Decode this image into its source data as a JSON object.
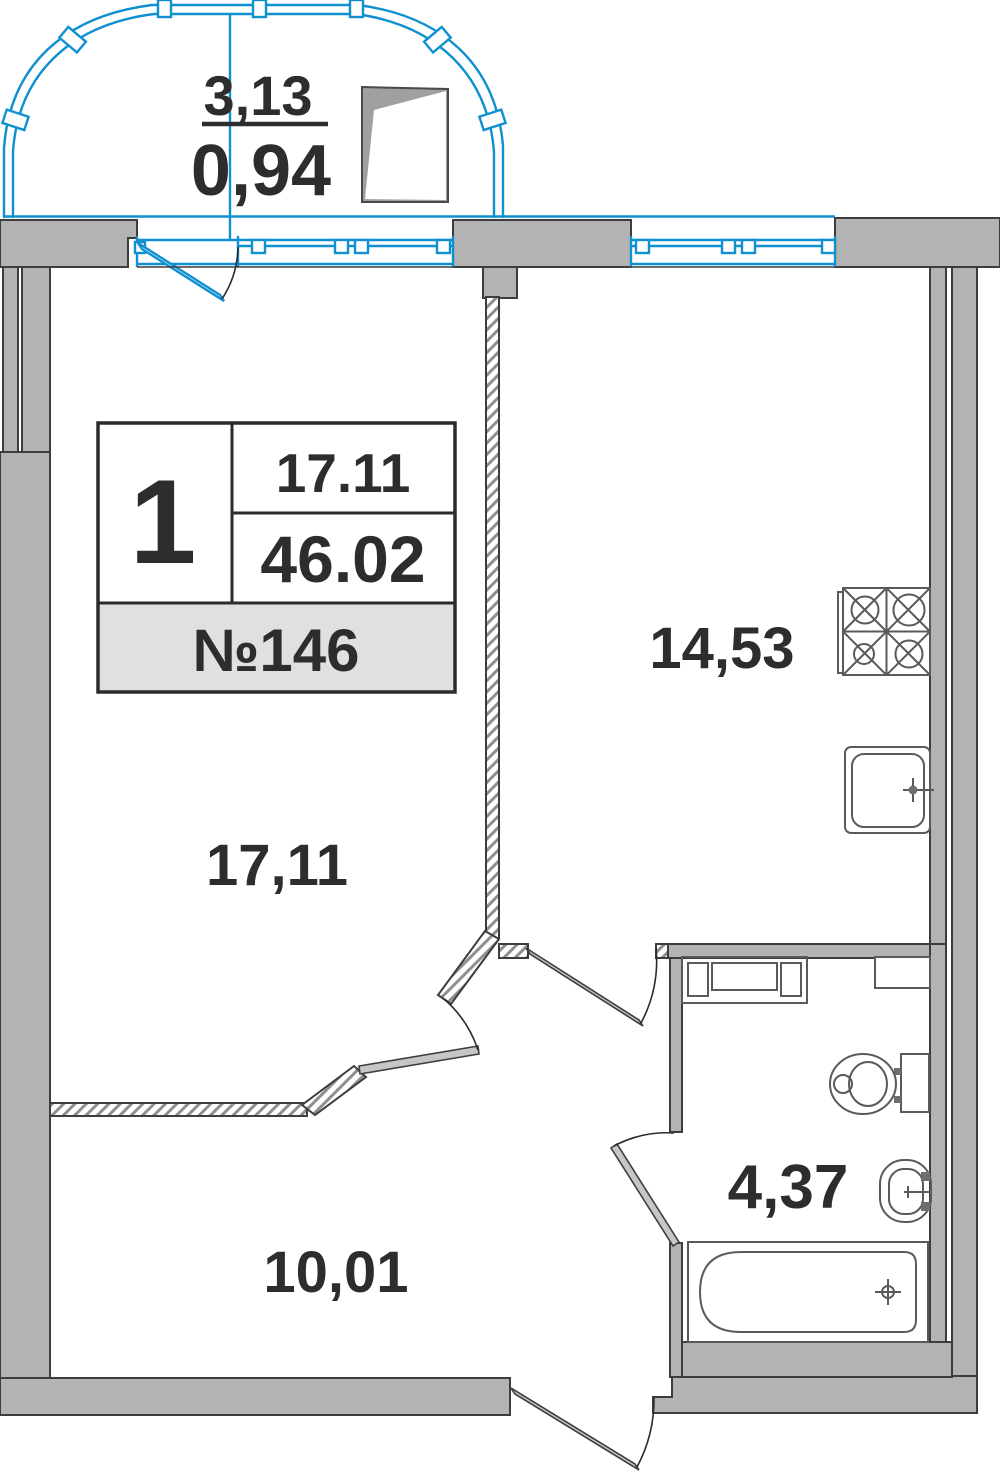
{
  "balcony": {
    "area_total": "3,13",
    "area_reduced": "0,94"
  },
  "info_card": {
    "rooms_count": "1",
    "living_area": "17.11",
    "total_area": "46.02",
    "unit_label": "№146"
  },
  "room_labels": {
    "living": "17,11",
    "kitchen": "14,53",
    "hall": "10,01",
    "bathroom": "4,37"
  },
  "colors": {
    "accent_blue": "#0e90d1",
    "wall_gray": "#b3b3b3",
    "outline_dark": "#3d3d3d",
    "card_row_bg": "#e0e0e0",
    "text_dark": "#2d2d2d"
  }
}
